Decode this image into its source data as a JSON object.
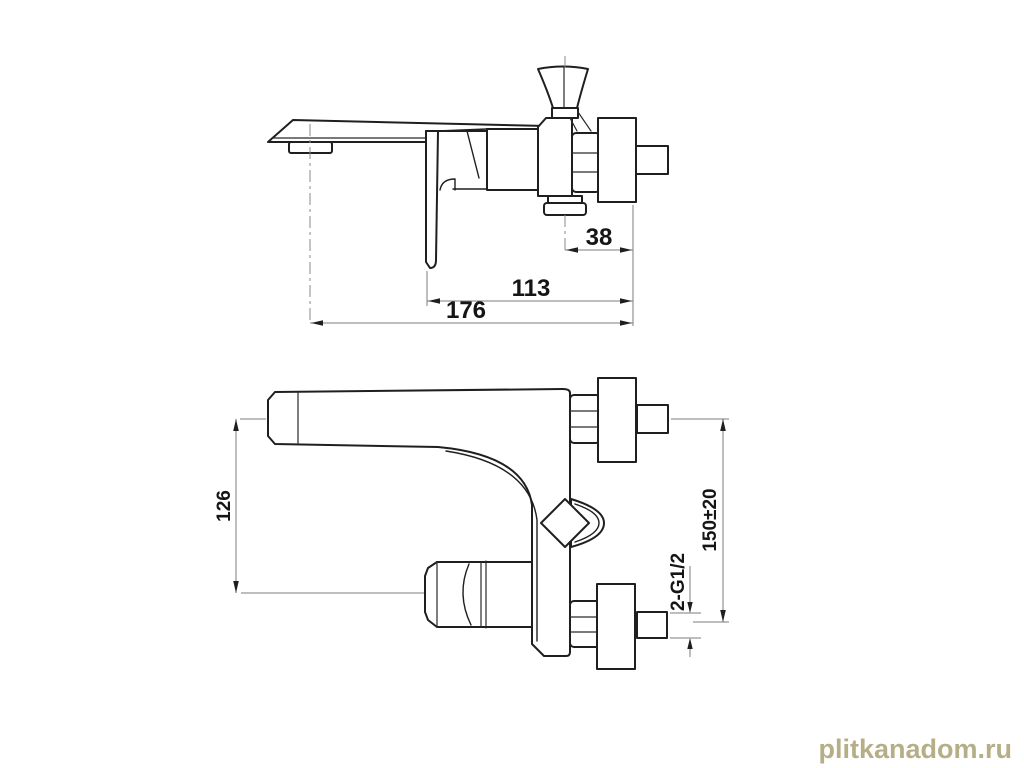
{
  "canvas": {
    "background": "#ffffff",
    "line_color": "#1f1f1f",
    "dimension_line_color": "#7d7d7d"
  },
  "views": {
    "top_view": {
      "name": "top view of wall-mounted mixer",
      "dim_38": "38",
      "dim_113": "113",
      "dim_176": "176"
    },
    "front_view": {
      "name": "plan view of wall-mounted mixer",
      "dim_126": "126",
      "dim_150": "150±20",
      "dim_thread": "2-G1/2"
    }
  },
  "watermark": {
    "text": "plitkanadom.ru",
    "color": "#b6ae86"
  }
}
